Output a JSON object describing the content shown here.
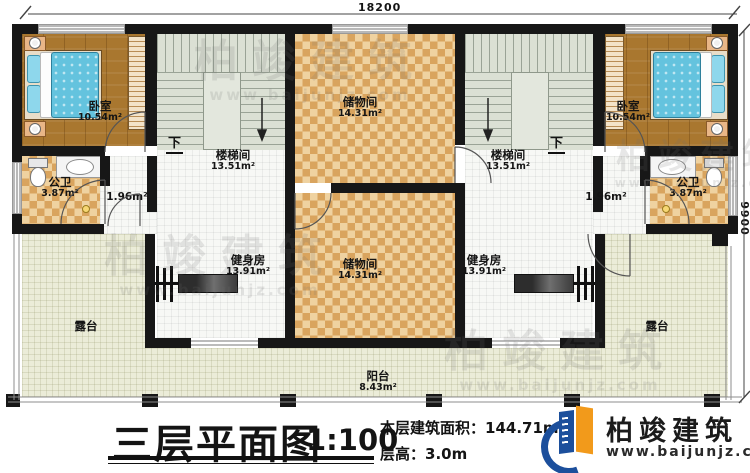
{
  "dimensions": {
    "width_top": "18200",
    "height_right": "9900"
  },
  "rooms": {
    "bedroom_left": {
      "label": "卧室",
      "area": "10.54m²"
    },
    "bedroom_right": {
      "label": "卧室",
      "area": "10.54m²"
    },
    "storage_top": {
      "label": "储物间",
      "area": "14.31m²"
    },
    "storage_center": {
      "label": "储物间",
      "area": "14.31m²"
    },
    "stair_left": {
      "label": "楼梯间",
      "area": "13.51m²"
    },
    "stair_right": {
      "label": "楼梯间",
      "area": "13.51m²"
    },
    "bath_left": {
      "label": "公卫",
      "area": "3.87m²"
    },
    "bath_right": {
      "label": "公卫",
      "area": "3.87m²"
    },
    "hall_left": {
      "area": "1.96m²"
    },
    "hall_right": {
      "area": "1.96m²"
    },
    "gym_left": {
      "label": "健身房",
      "area": "13.91m²"
    },
    "gym_right": {
      "label": "健身房",
      "area": "13.91m²"
    },
    "terrace_left": {
      "label": "露台"
    },
    "terrace_right": {
      "label": "露台"
    },
    "balcony": {
      "label": "阳台",
      "area": "8.43m²"
    }
  },
  "stairs": {
    "down_left": "下",
    "down_right": "下"
  },
  "title_block": {
    "title": "三层平面图",
    "scale": "1:100",
    "floor_area_label": "本层建筑面积：",
    "floor_area_value": "144.71m²",
    "floor_height_label": "层高：",
    "floor_height_value": "3.0m"
  },
  "brand": {
    "name": "柏竣建筑",
    "website": "www.baijunjz.com"
  },
  "watermark": {
    "text": "柏竣建筑",
    "subtext": "www.baijunjz.com"
  },
  "colors": {
    "wall": "#171717",
    "checker_dark": "#d9a45e",
    "checker_light": "#efd2a0",
    "wood": "#a9772f",
    "stair": "#dbe0d4",
    "terrace": "#ebecd8",
    "bed": "#64c3de",
    "brand_blue": "#1c4f9c",
    "brand_orange": "#f29a1b"
  }
}
